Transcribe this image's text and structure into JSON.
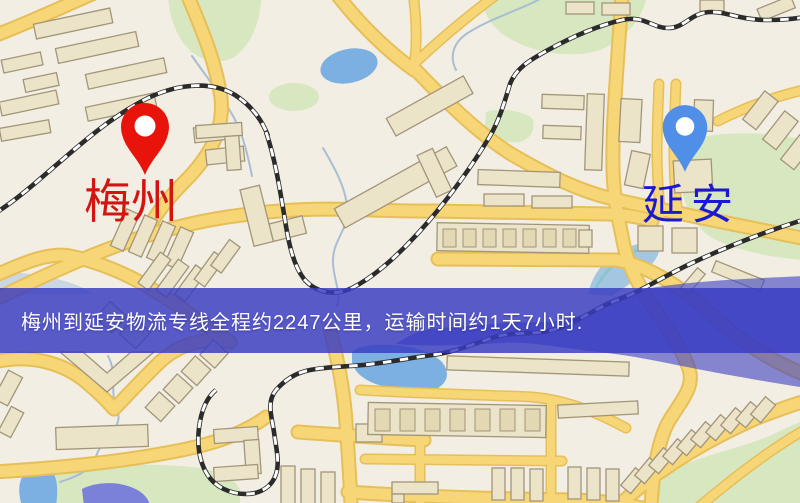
{
  "banner": {
    "text": "梅州到延安物流专线全程约2247公里，运输时间约1天7小时.",
    "distance_km": "2247",
    "duration": "1天7小时",
    "background_color": "#393cc2",
    "text_color": "#ffffff"
  },
  "markers": {
    "origin": {
      "label": "梅州",
      "pin_color": "#e8130a",
      "label_color": "#d31510"
    },
    "destination": {
      "label": "延安",
      "pin_color": "#4f8fe8",
      "label_color": "#1b18d0"
    }
  },
  "theme": {
    "map_background": "#f2eee3",
    "road_color": "#f7d678",
    "railway_color": "#2b2b2b",
    "building_color": "#ece4c8",
    "park_color": "#d7e7c0",
    "water_color": "#7cb0e2",
    "river_overlay_color": "#4043c2"
  }
}
